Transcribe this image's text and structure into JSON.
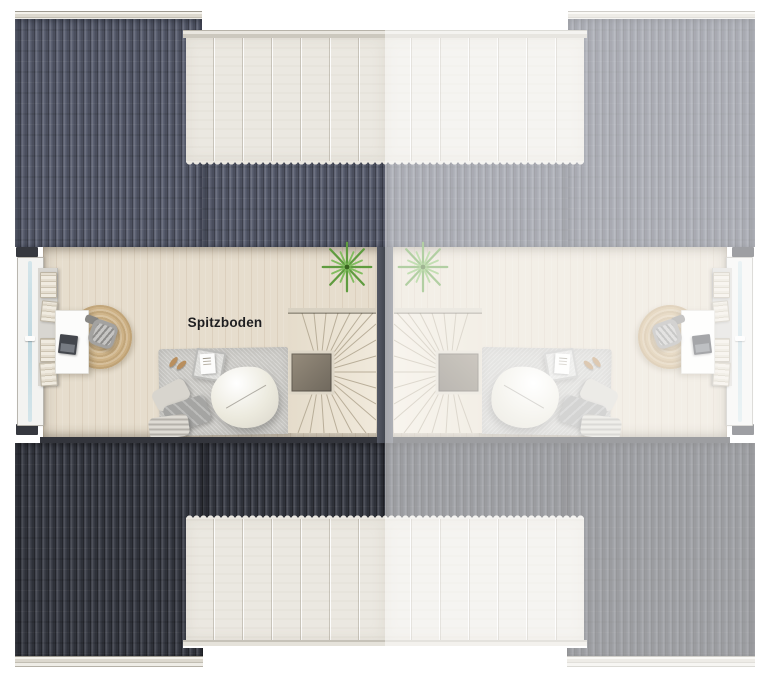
{
  "floorplan": {
    "room_label": "Spitzboden"
  },
  "colors": {
    "background": "#ffffff",
    "roof_top": "#575c6d",
    "roof_bottom": "#3a3d47",
    "right_unit_fade": "rgba(255,255,255,0.52)",
    "dormer_panels": "#ebe8e1",
    "ridge_cap": "#ddd9d0",
    "wood_floor": "#e6ddcd",
    "party_wall": "#4c505b",
    "window_glass": "#c7dce3",
    "area_rug": "#c9c8c4",
    "jute_rug": "#cdb185",
    "plant": "#5f9c3f",
    "label_text": "#1f1f21"
  }
}
